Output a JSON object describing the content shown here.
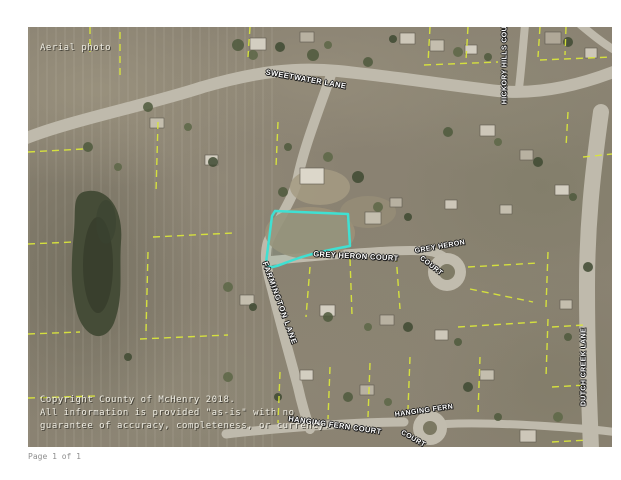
{
  "page": {
    "footer_text": "Page 1 of 1"
  },
  "map": {
    "photo_note": "Aerial photo",
    "street_labels": {
      "sweetwater": "SWEETWATER LANE",
      "hickory_hills": "HICKORY HILLS COURT",
      "grey_heron_road": "GREY HERON COURT",
      "grey_heron_cul_top": "GREY HERON",
      "grey_heron_cul_bottom": "COURT",
      "farmington": "FARMINGTON LANE",
      "hanging_fern_road": "HANGING FERN COURT",
      "hanging_fern_cul_top": "HANGING FERN",
      "hanging_fern_cul_bottom": "COURT",
      "dutch_creek": "DUTCH CREEK LANE"
    },
    "copyright": {
      "line1": "Copyright County of McHenry 2018.",
      "line2": "All information is provided \"as-is\" with no",
      "line3": "guarantee of accuracy, completeness, or currency."
    },
    "colors": {
      "parcel_highlight": "#3FE0D2",
      "parcel_boundary": "#D9E53C",
      "road": "#BFBAAC"
    }
  }
}
